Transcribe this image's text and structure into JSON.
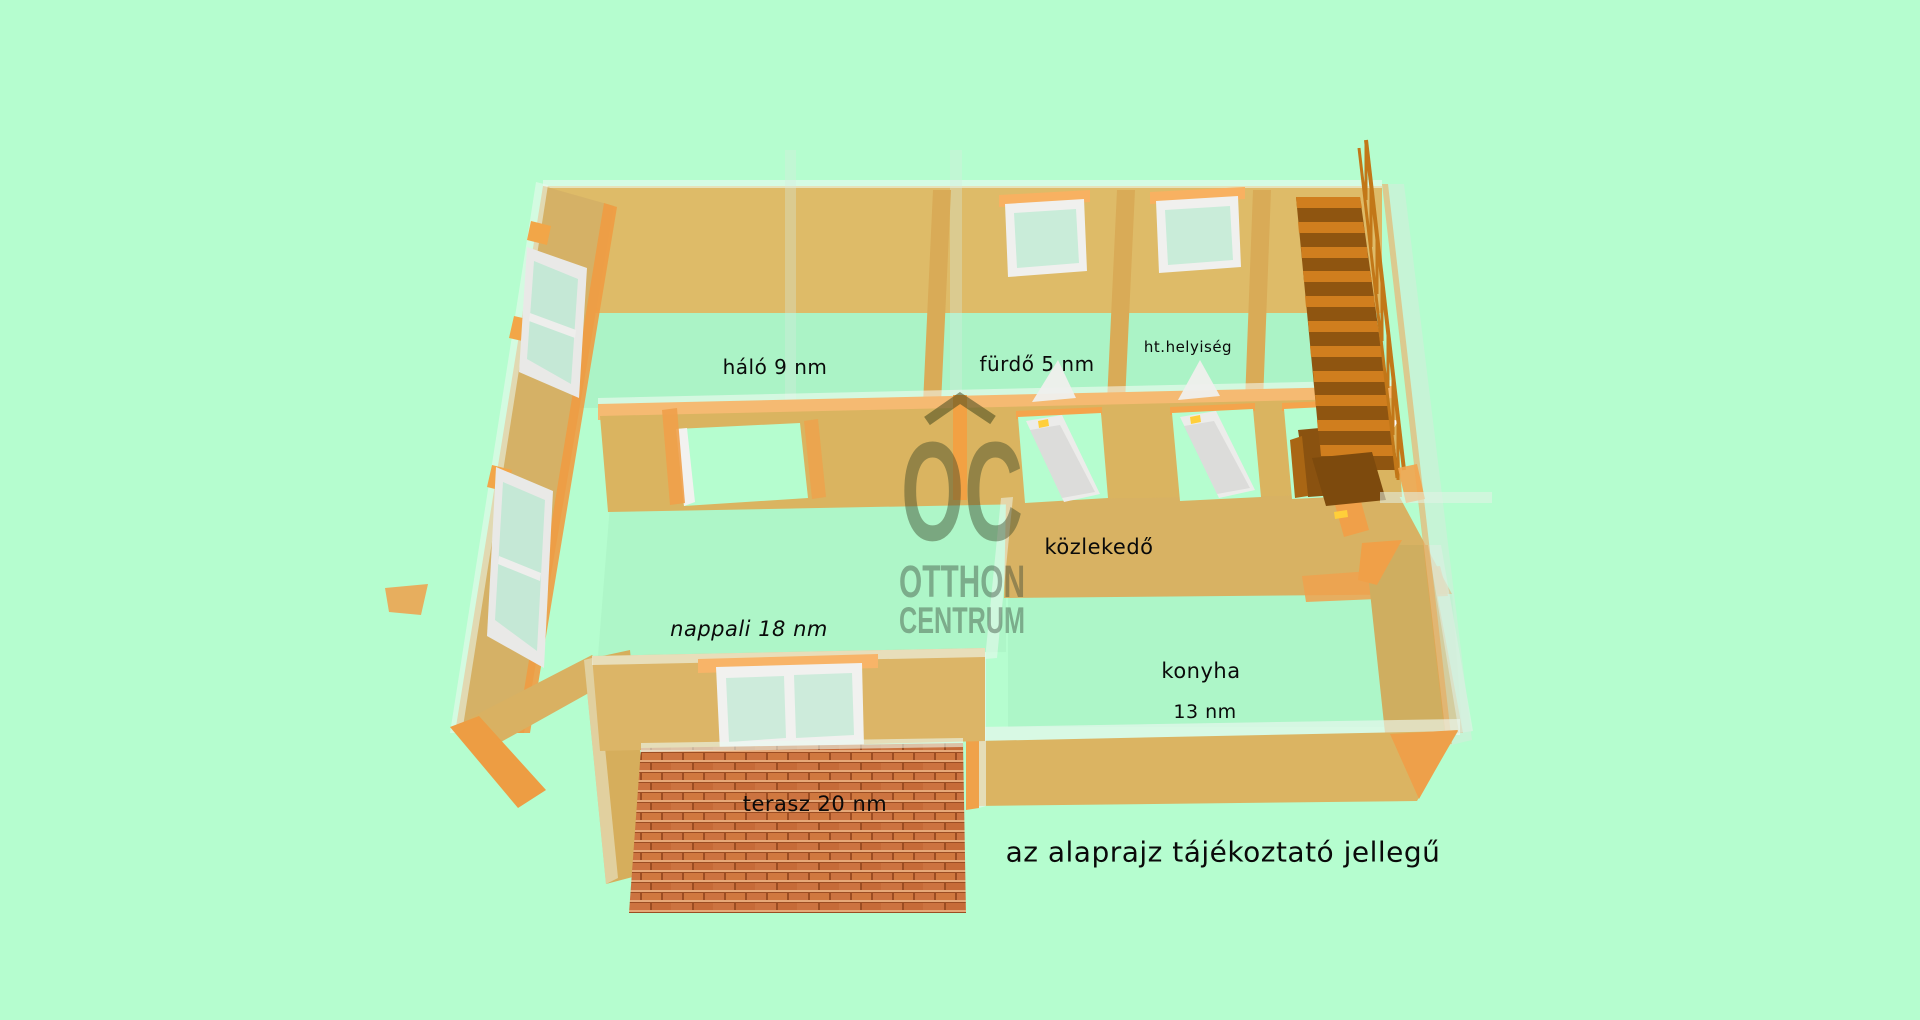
{
  "background": "#b5fdcf",
  "palette": {
    "background_mint": "#b5fdcf",
    "wall_tan": "#debb68",
    "wall_top_band": "#dab460",
    "accent_orange": "#f0a445",
    "stair_tread": "#d07e1e",
    "stair_riser": "#8f5510",
    "door_white": "#ececea",
    "handle_yellow": "#ffcf3a",
    "terrace_brick": "#cc7340",
    "glass_mint": "#c9ecd9",
    "watermark_gray": "rgba(60,70,45,0.45)",
    "text_black": "#0a0a0a"
  },
  "watermark": {
    "monogram": "OC",
    "line1": "OTTHON",
    "line2": "CENTRUM"
  },
  "labels": [
    {
      "id": "halo",
      "text": "háló 9 nm",
      "x": 775,
      "y": 367,
      "size": 20,
      "italic": false
    },
    {
      "id": "furdo",
      "text": "fürdő 5 nm",
      "x": 1037,
      "y": 364,
      "size": 20,
      "italic": false
    },
    {
      "id": "ht-helyiseg",
      "text": "ht.helyiség",
      "x": 1188,
      "y": 347,
      "size": 15,
      "italic": false
    },
    {
      "id": "kozlekedo",
      "text": "közlekedő",
      "x": 1099,
      "y": 547,
      "size": 21,
      "italic": false
    },
    {
      "id": "nappali",
      "text": "nappali 18 nm",
      "x": 749,
      "y": 629,
      "size": 21,
      "italic": true
    },
    {
      "id": "konyha",
      "text": "konyha",
      "x": 1201,
      "y": 671,
      "size": 21,
      "italic": false
    },
    {
      "id": "konyha-area",
      "text": "13 nm",
      "x": 1205,
      "y": 712,
      "size": 19,
      "italic": false
    },
    {
      "id": "terasz",
      "text": "terasz 20 nm",
      "x": 815,
      "y": 804,
      "size": 21,
      "italic": false
    }
  ],
  "disclaimer": {
    "text": "az alaprajz tájékoztató jellegű",
    "x": 1223,
    "y": 852,
    "size": 28,
    "italic": false
  }
}
